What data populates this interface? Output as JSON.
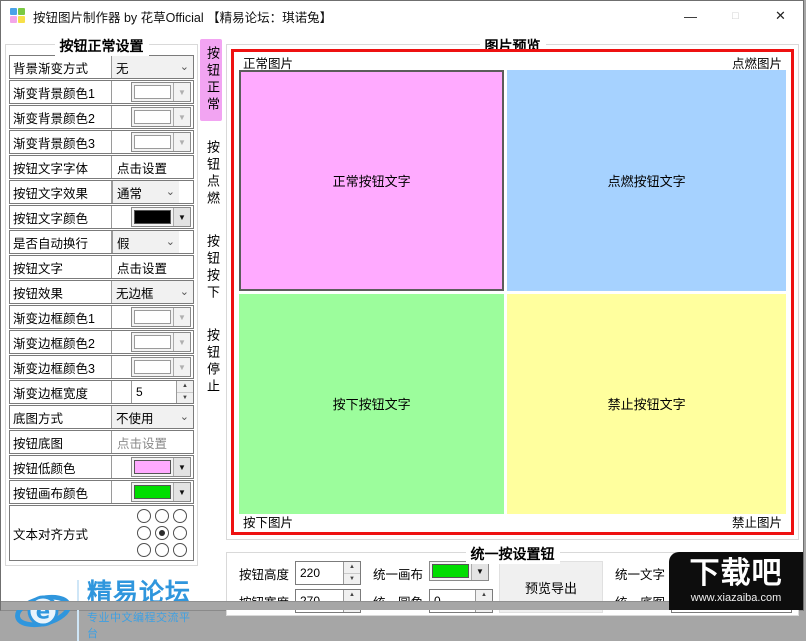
{
  "titlebar": {
    "title": "按钮图片制作器 by 花草Official 【精易论坛：琪诺兔】",
    "minimize_glyph": "—",
    "maximize_glyph": "□",
    "close_glyph": "✕",
    "icon_colors": [
      "#4aa3e8",
      "#7ac943",
      "#f3a6e8",
      "#f7e04a"
    ]
  },
  "left_panel": {
    "title": "按钮正常设置",
    "rows": [
      {
        "label": "背景渐变方式",
        "type": "select",
        "value": "无",
        "name": "bg-gradient-mode-select"
      },
      {
        "label": "渐变背景颜色1",
        "type": "color",
        "swatch": "#ffffff",
        "disabled": true,
        "name": "gradient-bg-color1-picker"
      },
      {
        "label": "渐变背景颜色2",
        "type": "color",
        "swatch": "#ffffff",
        "disabled": true,
        "name": "gradient-bg-color2-picker"
      },
      {
        "label": "渐变背景颜色3",
        "type": "color",
        "swatch": "#ffffff",
        "disabled": true,
        "name": "gradient-bg-color3-picker"
      },
      {
        "label": "按钮文字字体",
        "type": "text",
        "value": "点击设置",
        "name": "button-font-setting"
      },
      {
        "label": "按钮文字效果",
        "type": "select",
        "value": "通常",
        "narrow": true,
        "name": "text-effect-select"
      },
      {
        "label": "按钮文字颜色",
        "type": "color",
        "swatch": "#000000",
        "name": "text-color-picker"
      },
      {
        "label": "是否自动换行",
        "type": "select",
        "value": "假",
        "narrow": true,
        "name": "auto-wrap-select"
      },
      {
        "label": "按钮文字",
        "type": "text",
        "value": "点击设置",
        "name": "button-text-setting"
      },
      {
        "label": "按钮效果",
        "type": "select",
        "value": "无边框",
        "name": "button-effect-select"
      },
      {
        "label": "渐变边框颜色1",
        "type": "color",
        "swatch": "#ffffff",
        "disabled": true,
        "name": "gradient-border-color1-picker"
      },
      {
        "label": "渐变边框颜色2",
        "type": "color",
        "swatch": "#ffffff",
        "disabled": true,
        "name": "gradient-border-color2-picker"
      },
      {
        "label": "渐变边框颜色3",
        "type": "color",
        "swatch": "#ffffff",
        "disabled": true,
        "name": "gradient-border-color3-picker"
      },
      {
        "label": "渐变边框宽度",
        "type": "spin",
        "value": "5",
        "name": "border-width-stepper"
      },
      {
        "label": "底图方式",
        "type": "select",
        "value": "不使用",
        "name": "base-image-mode-select"
      },
      {
        "label": "按钮底图",
        "type": "text",
        "value": "点击设置",
        "muted": true,
        "name": "base-image-setting"
      },
      {
        "label": "按钮低颜色",
        "type": "color",
        "swatch": "#ffaaff",
        "name": "button-low-color-picker"
      },
      {
        "label": "按钮画布颜色",
        "type": "color",
        "swatch": "#00dd00",
        "name": "button-canvas-color-picker"
      }
    ],
    "align": {
      "label": "文本对齐方式",
      "selected_index": 4
    }
  },
  "side_tabs": [
    {
      "label": "按钮正常",
      "selected": true,
      "selected_color": "#f2a4f2"
    },
    {
      "label": "按钮点燃",
      "selected": false
    },
    {
      "label": "按钮按下",
      "selected": false
    },
    {
      "label": "按钮停止",
      "selected": false
    }
  ],
  "preview": {
    "title": "图片预览",
    "frame_color": "#ee1111",
    "corner_labels": {
      "top_left": "正常图片",
      "top_right": "点燃图片",
      "bottom_left": "按下图片",
      "bottom_right": "禁止图片"
    },
    "quads": [
      {
        "name": "normal-preview",
        "label": "正常按钮文字",
        "color": "#ffaaff",
        "selected": true
      },
      {
        "name": "hover-preview",
        "label": "点燃按钮文字",
        "color": "#a6d2ff",
        "selected": false
      },
      {
        "name": "pressed-preview",
        "label": "按下按钮文字",
        "color": "#9cfd9c",
        "selected": false
      },
      {
        "name": "disabled-preview",
        "label": "禁止按钮文字",
        "color": "#ffff9e",
        "selected": false
      }
    ]
  },
  "unify": {
    "title": "统一按设置钮",
    "height_label": "按钮高度",
    "height_value": "220",
    "width_label": "按钮宽度",
    "width_value": "270",
    "canvas_label": "统一画布",
    "canvas_color": "#00dd00",
    "corner_label": "统一圆角",
    "corner_value": "0",
    "export_button": "预览导出",
    "text_label": "统一文字",
    "text_value": "点击设置",
    "image_label": "统一底图",
    "image_value": "点击设置"
  },
  "logo": {
    "title": "精易论坛",
    "subtitle": "专业中文编程交流平台",
    "glyph": "e"
  },
  "watermark": {
    "brand": "下载吧",
    "url": "www.xiazaiba.com"
  }
}
